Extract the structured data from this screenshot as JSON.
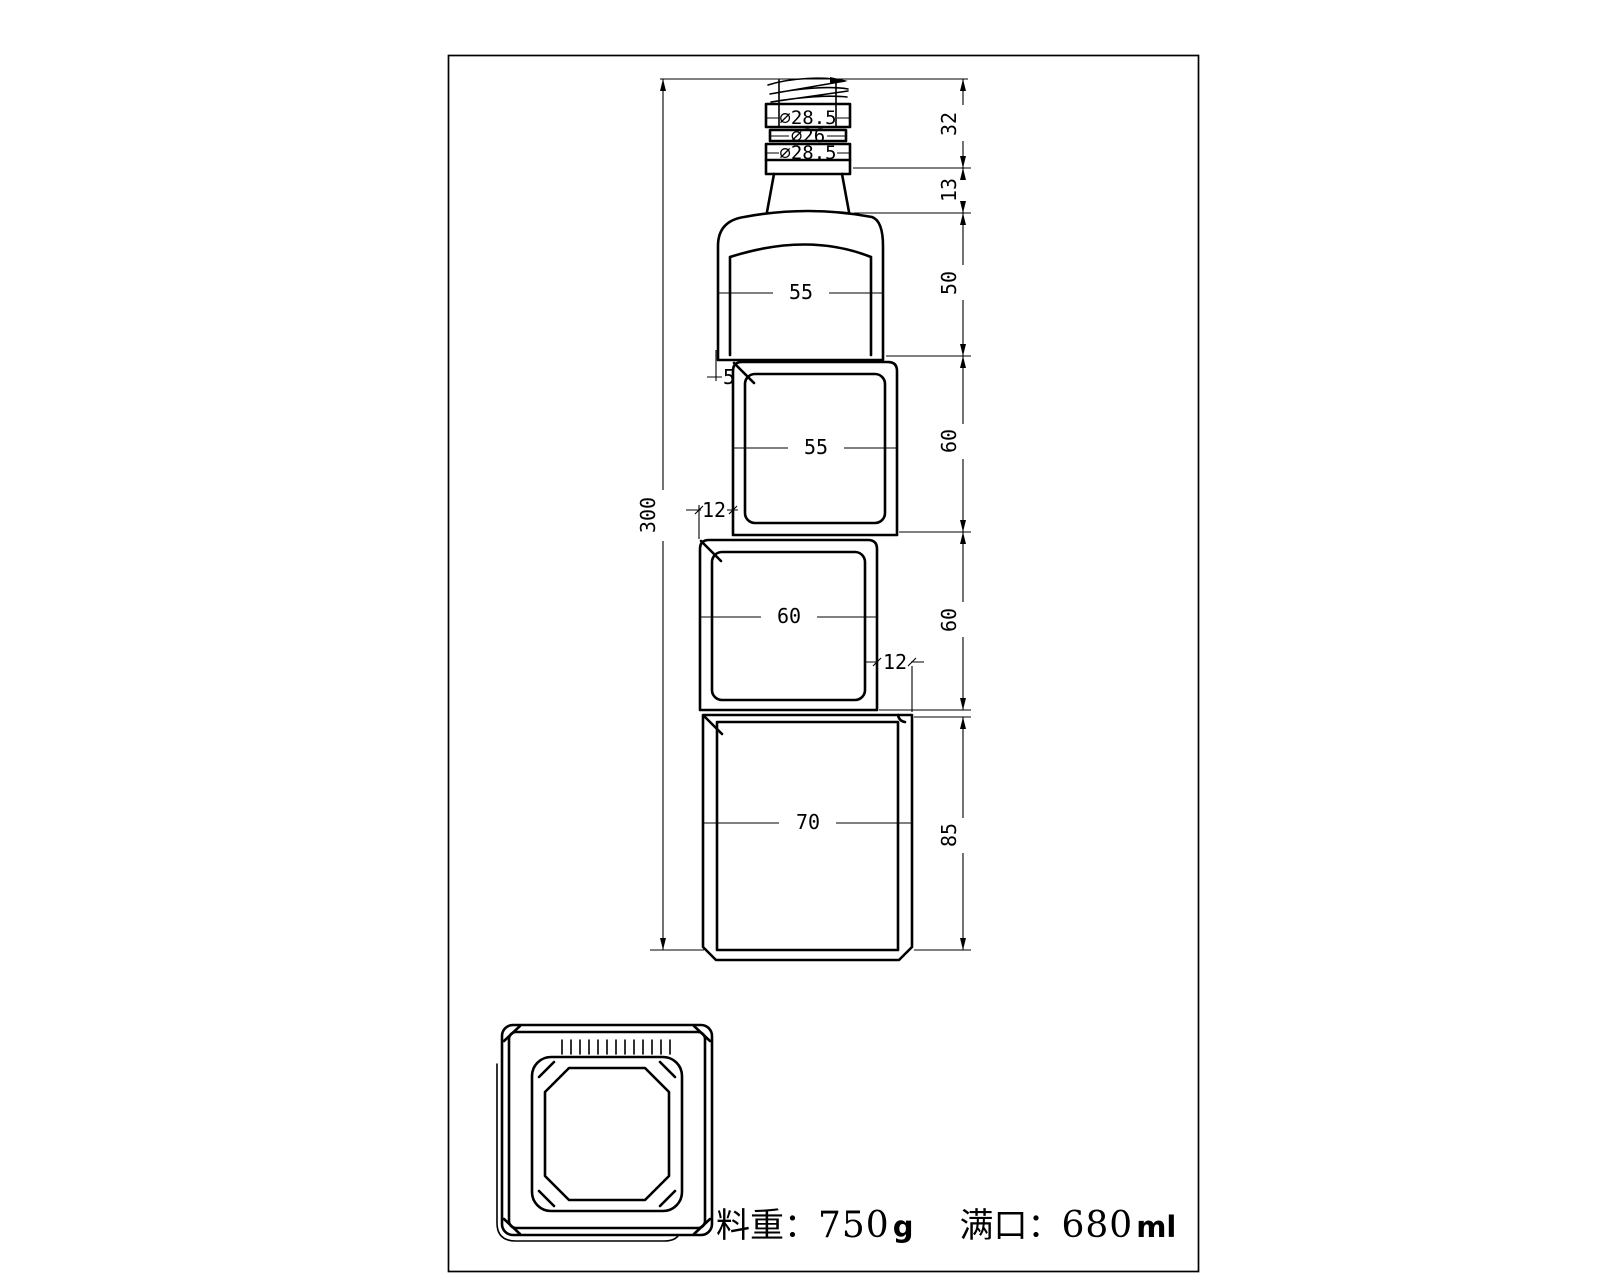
{
  "front_view": {
    "neck_diameters": {
      "top": "∅28.5",
      "middle": "∅26",
      "bottom": "∅28.5"
    },
    "section_widths": {
      "s1": "55",
      "s2": "55",
      "s3": "60",
      "s4": "70"
    },
    "section_heights": {
      "thread": "32",
      "neck": "13",
      "s1": "50",
      "s2": "60",
      "s3": "60",
      "s4": "85"
    },
    "overall_height": "300",
    "offsets": {
      "s1_s2": "5",
      "s2_s3": "12",
      "s3_s4": "12"
    }
  },
  "footer": {
    "weight_label": "料重：",
    "weight_value": "750",
    "weight_unit": "g",
    "capacity_label": "满口：",
    "capacity_value": "680",
    "capacity_unit": "ml"
  }
}
